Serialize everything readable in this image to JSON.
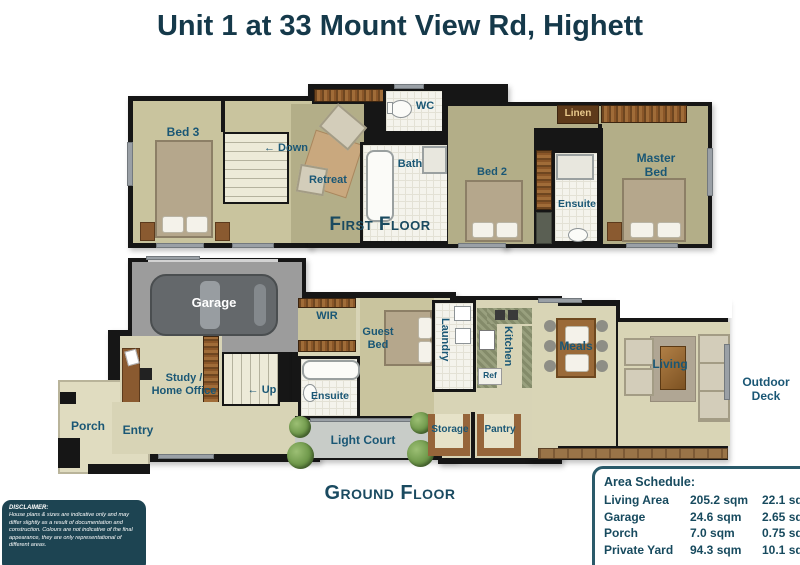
{
  "page": {
    "title": "Unit 1 at 33 Mount View Rd, Highett"
  },
  "icons": {
    "left_arrow": "←"
  },
  "colors": {
    "accent_teal": "#1a5775",
    "title_teal": "#15394a",
    "wall_black": "#161616",
    "room_khaki": "#cbc6a0",
    "room_olive": "#b3ae88",
    "room_cream": "#d8d4b6",
    "cabinet_brown": "#8a5a30",
    "garage_gray": "#9c9c9c"
  },
  "floors": {
    "first": {
      "caption": "First Floor",
      "rooms": {
        "bed3": "Bed 3",
        "down": "Down",
        "retreat": "Retreat",
        "wc": "WC",
        "bath": "Bath",
        "linen": "Linen",
        "bed2": "Bed 2",
        "ensuite": "Ensuite",
        "master_line1": "Master",
        "master_line2": "Bed"
      }
    },
    "ground": {
      "caption": "Ground Floor",
      "rooms": {
        "garage": "Garage",
        "study_line1": "Study /",
        "study_line2": "Home Office",
        "porch": "Porch",
        "entry": "Entry",
        "up": "Up",
        "wir": "WIR",
        "ensuite": "Ensuite",
        "guest_line1": "Guest",
        "guest_line2": "Bed",
        "laundry": "Laundry",
        "kitchen": "Kitchen",
        "ref": "Ref",
        "storage": "Storage",
        "pantry": "Pantry",
        "light_court": "Light Court",
        "meals": "Meals",
        "living": "Living",
        "outdoor_line1": "Outdoor",
        "outdoor_line2": "Deck"
      }
    }
  },
  "schedule": {
    "title": "Area Schedule:",
    "rows": [
      {
        "name": "Living Area",
        "metric": "205.2 sqm",
        "imperial": "22.1 sq"
      },
      {
        "name": "Garage",
        "metric": "24.6 sqm",
        "imperial": "2.65 sq"
      },
      {
        "name": "Porch",
        "metric": "7.0 sqm",
        "imperial": "0.75 sq"
      },
      {
        "name": "Private Yard",
        "metric": "94.3 sqm",
        "imperial": "10.1 sq"
      }
    ]
  },
  "disclaimer": {
    "title": "DISCLAIMER:",
    "body": "House plans & sizes are indicative only and may differ slightly as a result of documentation and construction. Colours are not indicative of the final appearance, they are only representational of different areas."
  }
}
